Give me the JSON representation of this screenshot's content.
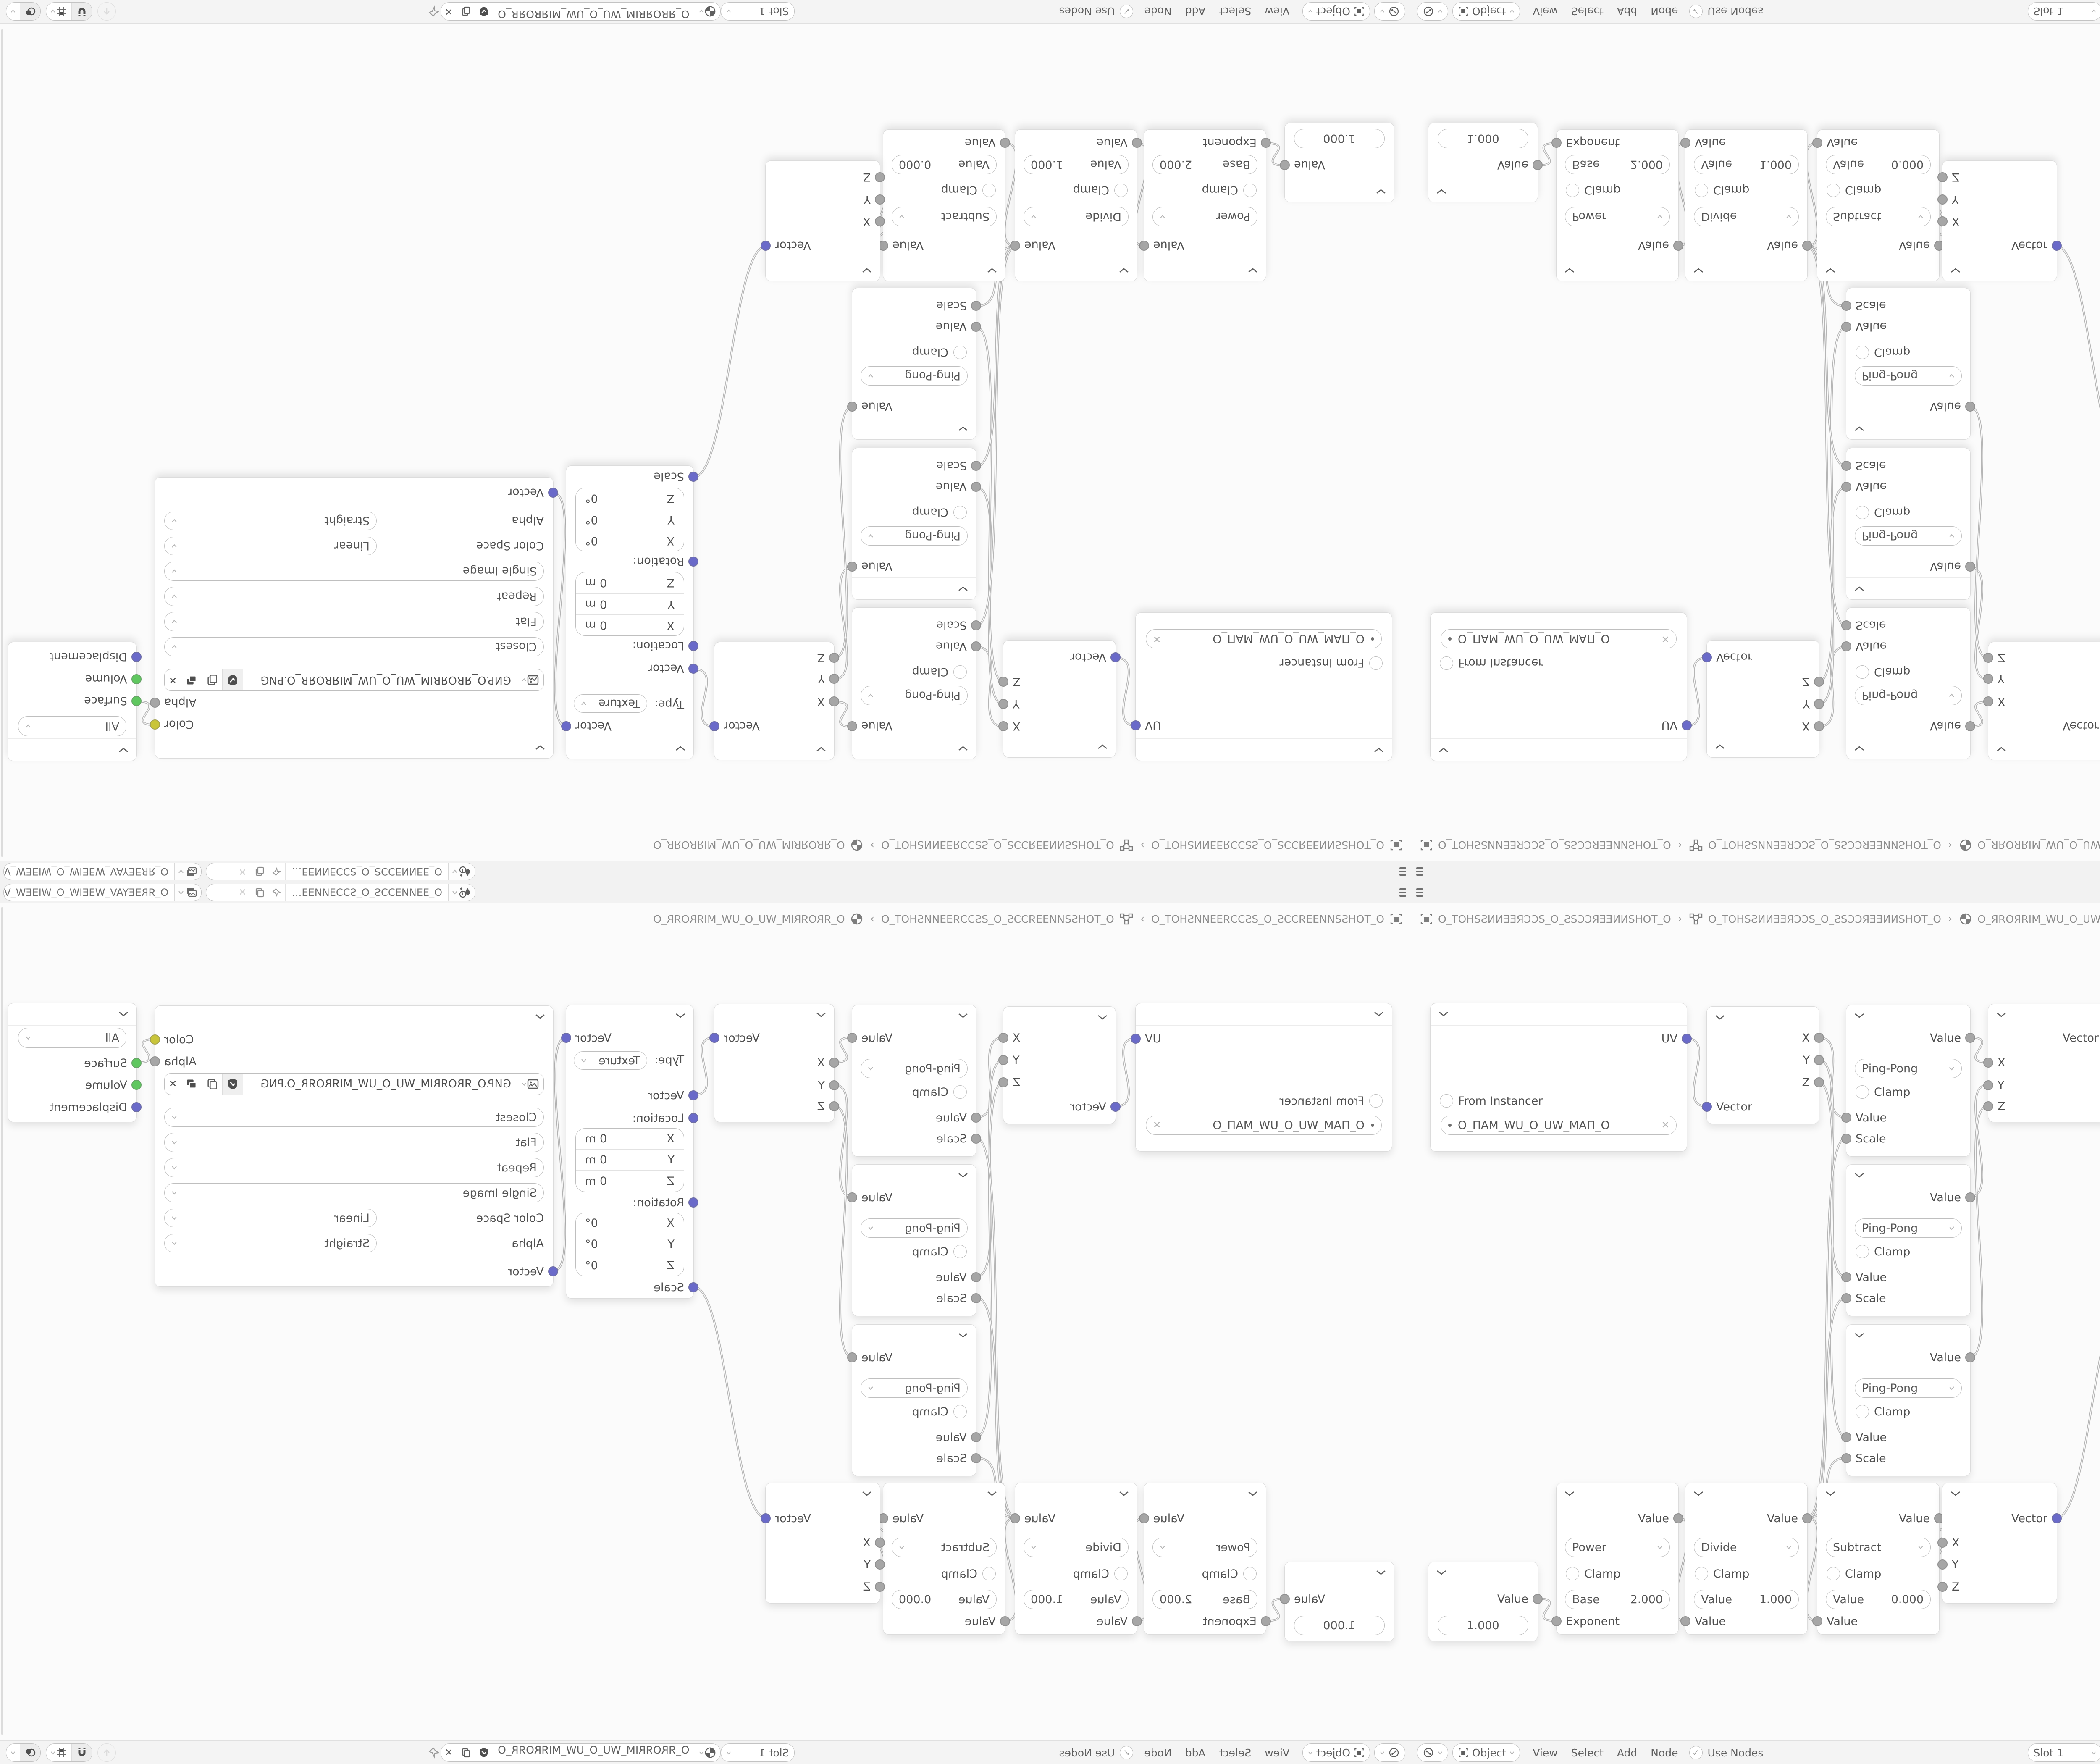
{
  "glyphs": {
    "close": "✕",
    "check": "✓",
    "separator": "›",
    "ellipsis_name_scene": "O_ƎƎͶИƎƆƆS_O_SƆƆƎИͶƎƎ…"
  },
  "colors": {
    "vector_socket": "#6a6ac9",
    "value_socket": "#a6a6a6",
    "color_socket": "#c9c53a",
    "shader_socket": "#5fc75f",
    "wire": "#b5b5b5",
    "node_bg": "#ffffff",
    "editor_bg": "#fbfbfb",
    "bar_bg": "#f2f2f2"
  },
  "topbar": {
    "scene_name": "O_ƎƎͶИƎƆƆS_O_SƆƆƎИͶƎƎ…",
    "view_layer_name": "O_ЯRƎEYAV_WƎEIW_O_WIƎEW_VAYƎERЯ_O"
  },
  "breadcrumb": {
    "scene": "O_TOHSƧͶИƎƎЯƆƆS_O_ƧSƆƆЯƎƎͶИSHOT_O",
    "object": "O_TOHSƧͶИƎƎЯƆƆS_O_ƧSƆƆЯƎƎͶИSHOT_O",
    "material": "O_ЯROЯRIM_WU_O_UW_MIЯROЯR_O"
  },
  "header": {
    "mode": "Object",
    "menus": [
      "View",
      "Select",
      "Add",
      "Node"
    ],
    "use_nodes": "Use Nodes",
    "slot": "Slot 1",
    "material": "O_ЯROЯRIM_WU_O_UW_MIЯROЯR_O"
  },
  "nodes": {
    "uv_map": {
      "output": "UV",
      "from_instancer": "From Instancer",
      "uv_name": "O_ПAM_WU_O_UW_MAП_O"
    },
    "separate_xyz": {
      "out_x": "X",
      "out_y": "Y",
      "out_z": "Z",
      "input": "Vector"
    },
    "pingpong": {
      "output": "Value",
      "operation": "Ping-Pong",
      "clamp": "Clamp",
      "in_value": "Value",
      "in_scale": "Scale"
    },
    "combine_xyz": {
      "output": "Vector",
      "in_x": "X",
      "in_y": "Y",
      "in_z": "Z"
    },
    "mapping": {
      "output": "Vector",
      "type_label": "Type:",
      "type": "Texture",
      "in_vector": "Vector",
      "location_label": "Location:",
      "rotation_label": "Rotation:",
      "scale_label": "Scale",
      "loc_rows": [
        {
          "axis": "X",
          "value": "0 m"
        },
        {
          "axis": "Y",
          "value": "0 m"
        },
        {
          "axis": "Z",
          "value": "0 m"
        }
      ],
      "rot_rows": [
        {
          "axis": "X",
          "value": "0°"
        },
        {
          "axis": "Y",
          "value": "0°"
        },
        {
          "axis": "Z",
          "value": "0°"
        }
      ]
    },
    "image_texture": {
      "out_color": "Color",
      "out_alpha": "Alpha",
      "filename": "GИP.O_ЯROЯRIM_WU_O_UW_MIЯROЯR_O.PNG",
      "interpolation": "Closest",
      "projection": "Flat",
      "extension": "Repeat",
      "source": "Single Image",
      "color_space_label": "Color Space",
      "color_space": "Linear",
      "alpha_label": "Alpha",
      "alpha_mode": "Straight",
      "in_vector": "Vector"
    },
    "material_output": {
      "target": "All",
      "in_surface": "Surface",
      "in_volume": "Volume",
      "in_displacement": "Displacement"
    },
    "value": {
      "output": "Value",
      "value": "1.000"
    },
    "power": {
      "output": "Value",
      "operation": "Power",
      "clamp": "Clamp",
      "field_label": "Base",
      "field_value": "2.000",
      "input": "Exponent"
    },
    "divide": {
      "output": "Value",
      "operation": "Divide",
      "clamp": "Clamp",
      "field_label": "Value",
      "field_value": "1.000",
      "input": "Value"
    },
    "subtract": {
      "output": "Value",
      "operation": "Subtract",
      "clamp": "Clamp",
      "field_label": "Value",
      "field_value": "0.000",
      "input": "Value"
    }
  },
  "links": [
    [
      655,
      372,
      703,
      534
    ],
    [
      970,
      370,
      1035,
      560
    ],
    [
      970,
      423,
      1035,
      940
    ],
    [
      970,
      476,
      1035,
      1321
    ],
    [
      1330,
      370,
      1373,
      429
    ],
    [
      1330,
      750,
      1373,
      483
    ],
    [
      1330,
      1131,
      1373,
      533
    ],
    [
      1658,
      370,
      1708,
      507
    ],
    [
      2011,
      370,
      2042,
      926
    ],
    [
      2990,
      374,
      3034,
      430
    ],
    [
      300,
      1706,
      345,
      1759
    ],
    [
      635,
      1514,
      652,
      1759
    ],
    [
      942,
      1514,
      966,
      1759
    ],
    [
      1256,
      1514,
      1264,
      1572
    ],
    [
      1256,
      1514,
      1264,
      1624
    ],
    [
      1256,
      1514,
      1264,
      1677
    ],
    [
      1536,
      1514,
      1708,
      964
    ],
    [
      942,
      1514,
      1035,
      610
    ],
    [
      942,
      1514,
      1035,
      990
    ],
    [
      942,
      1514,
      1035,
      1371
    ]
  ]
}
